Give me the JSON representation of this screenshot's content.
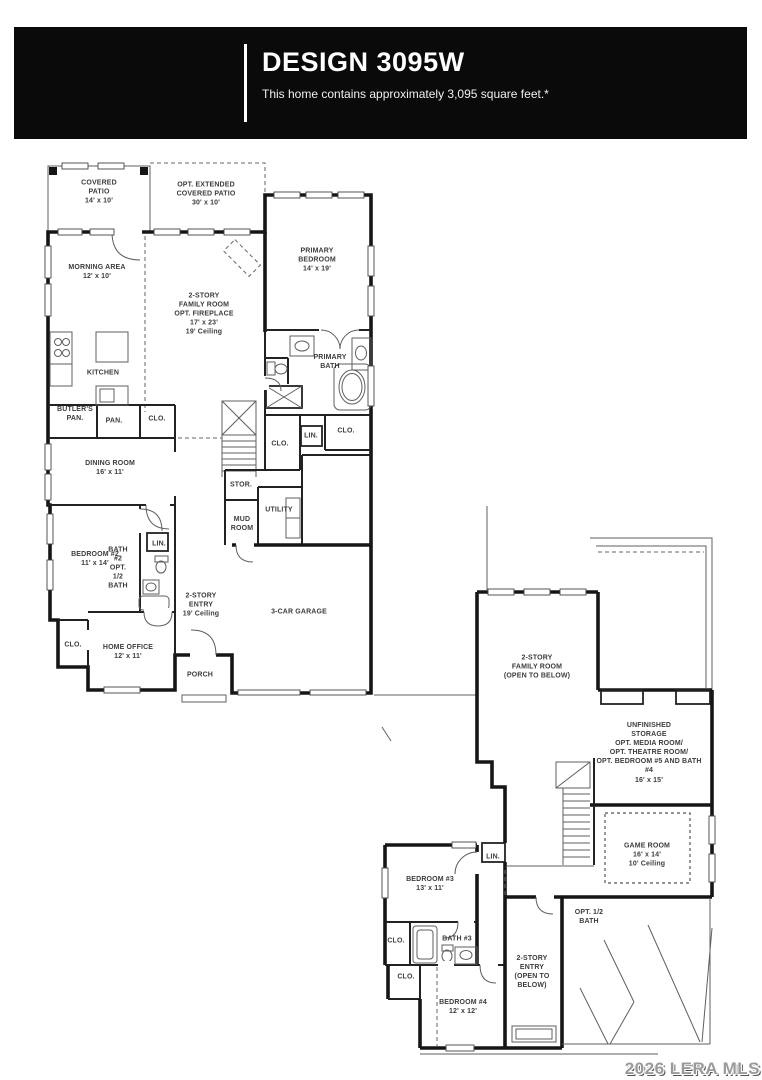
{
  "header": {
    "title": "DESIGN 3095W",
    "subtitle": "This home contains approximately 3,095 square feet.*"
  },
  "watermark": "2026 LERA MLS",
  "colors": {
    "banner_bg": "#0a0a0a",
    "banner_text": "#ffffff",
    "wall": "#161616",
    "label_text": "#3c3c3c"
  },
  "floors": [
    {
      "id": "first-floor",
      "labels": [
        {
          "id": "covered-patio",
          "text": "COVERED\nPATIO\n14' x 10'",
          "x": 99,
          "y": 192
        },
        {
          "id": "opt-extended-patio",
          "text": "OPT. EXTENDED\nCOVERED PATIO\n30' x 10'",
          "x": 206,
          "y": 194
        },
        {
          "id": "morning-area",
          "text": "MORNING AREA\n12' x 10'",
          "x": 97,
          "y": 272
        },
        {
          "id": "family-room-1",
          "text": "2-STORY\nFAMILY ROOM\nOPT. FIREPLACE\n17' x 23'\n19' Ceiling",
          "x": 204,
          "y": 314
        },
        {
          "id": "primary-bedroom",
          "text": "PRIMARY\nBEDROOM\n14' x 19'",
          "x": 317,
          "y": 260
        },
        {
          "id": "kitchen",
          "text": "KITCHEN",
          "x": 103,
          "y": 373
        },
        {
          "id": "primary-bath",
          "text": "PRIMARY\nBATH",
          "x": 330,
          "y": 362
        },
        {
          "id": "butlers-pantry",
          "text": "BUTLER'S\nPAN.",
          "x": 75,
          "y": 414
        },
        {
          "id": "pantry",
          "text": "PAN.",
          "x": 114,
          "y": 421
        },
        {
          "id": "clo-pantry",
          "text": "CLO.",
          "x": 157,
          "y": 419
        },
        {
          "id": "clo-hall",
          "text": "CLO.",
          "x": 280,
          "y": 444
        },
        {
          "id": "lin-hall",
          "text": "LIN.",
          "x": 311,
          "y": 436
        },
        {
          "id": "clo-primary",
          "text": "CLO.",
          "x": 346,
          "y": 431
        },
        {
          "id": "dining-room",
          "text": "DINING ROOM\n16' x 11'",
          "x": 110,
          "y": 468
        },
        {
          "id": "storage-closet",
          "text": "STOR.",
          "x": 241,
          "y": 485
        },
        {
          "id": "utility",
          "text": "UTILITY",
          "x": 279,
          "y": 510
        },
        {
          "id": "mud-room",
          "text": "MUD\nROOM",
          "x": 242,
          "y": 524
        },
        {
          "id": "bedroom-2",
          "text": "BEDROOM #2\n11' x 14'",
          "x": 95,
          "y": 559
        },
        {
          "id": "lin-bath2",
          "text": "LIN.",
          "x": 159,
          "y": 544
        },
        {
          "id": "bath-2",
          "text": "BATH\n#2\nOPT.\n1/2\nBATH",
          "x": 118,
          "y": 568
        },
        {
          "id": "entry-1",
          "text": "2-STORY\nENTRY\n19' Ceiling",
          "x": 201,
          "y": 605
        },
        {
          "id": "garage",
          "text": "3-CAR GARAGE",
          "x": 299,
          "y": 612
        },
        {
          "id": "clo-office",
          "text": "CLO.",
          "x": 73,
          "y": 645
        },
        {
          "id": "home-office",
          "text": "HOME OFFICE\n12' x 11'",
          "x": 128,
          "y": 652
        },
        {
          "id": "porch",
          "text": "PORCH",
          "x": 200,
          "y": 675
        }
      ]
    },
    {
      "id": "second-floor",
      "labels": [
        {
          "id": "family-room-2",
          "text": "2-STORY\nFAMILY ROOM\n(OPEN TO BELOW)",
          "x": 537,
          "y": 667
        },
        {
          "id": "unfinished-storage",
          "text": "UNFINISHED\nSTORAGE\nOPT. MEDIA ROOM/\nOPT. THEATRE ROOM/\nOPT. BEDROOM #5 AND BATH #4\n16' x 15'",
          "x": 649,
          "y": 753
        },
        {
          "id": "game-room",
          "text": "GAME ROOM\n16' x 14'\n10' Ceiling",
          "x": 647,
          "y": 855
        },
        {
          "id": "lin-2",
          "text": "LIN.",
          "x": 493,
          "y": 857
        },
        {
          "id": "bedroom-3",
          "text": "BEDROOM #3\n13' x 11'",
          "x": 430,
          "y": 884
        },
        {
          "id": "clo-bath3",
          "text": "CLO.",
          "x": 396,
          "y": 941
        },
        {
          "id": "bath-3",
          "text": "BATH #3",
          "x": 457,
          "y": 939
        },
        {
          "id": "clo-bedroom4",
          "text": "CLO.",
          "x": 406,
          "y": 977
        },
        {
          "id": "opt-half-bath",
          "text": "OPT. 1/2\nBATH",
          "x": 589,
          "y": 917
        },
        {
          "id": "entry-2",
          "text": "2-STORY\nENTRY\n(OPEN TO\nBELOW)",
          "x": 532,
          "y": 972
        },
        {
          "id": "bedroom-4",
          "text": "BEDROOM #4\n12' x 12'",
          "x": 463,
          "y": 1007
        }
      ]
    }
  ]
}
